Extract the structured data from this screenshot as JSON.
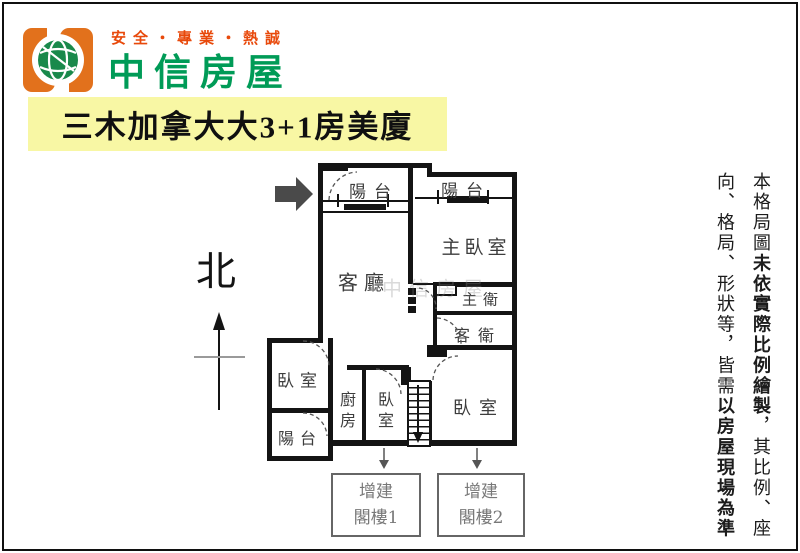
{
  "header": {
    "slogan": "安全・專業・熱誠",
    "brand": "中信房屋",
    "listing_title": "三木加拿大大3+1房美廈"
  },
  "compass": {
    "north_label": "北"
  },
  "floor_plan": {
    "rooms": {
      "balcony_top_left": "陽台",
      "balcony_top_right": "陽台",
      "master_bedroom": "主臥室",
      "living_room": "客廳",
      "master_bath": "主衛",
      "guest_bath": "客衛",
      "bedroom_left": "臥室",
      "balcony_lower_left": "陽台",
      "kitchen": "廚房",
      "bedroom_middle": "臥室",
      "bedroom_right": "臥室"
    },
    "annex_boxes": [
      {
        "line1": "增建",
        "line2": "閣樓1"
      },
      {
        "line1": "增建",
        "line2": "閣樓2"
      }
    ],
    "watermark": "中信房屋"
  },
  "disclaimer": {
    "segments": [
      {
        "text": "本格局圖",
        "bold": false
      },
      {
        "text": "未依實際比例繪製",
        "bold": true
      },
      {
        "text": "，其比例、座向、格局、形狀等，皆需",
        "bold": false
      },
      {
        "text": "以房屋現場為準",
        "bold": true
      }
    ]
  },
  "colors": {
    "brand_orange": "#e2711c",
    "slogan_red": "#e8490b",
    "brand_green": "#009b57",
    "globe_green": "#19894b",
    "banner_yellow": "#f8f7a4",
    "wall_black": "#141414",
    "annex_gray": "#787878"
  }
}
